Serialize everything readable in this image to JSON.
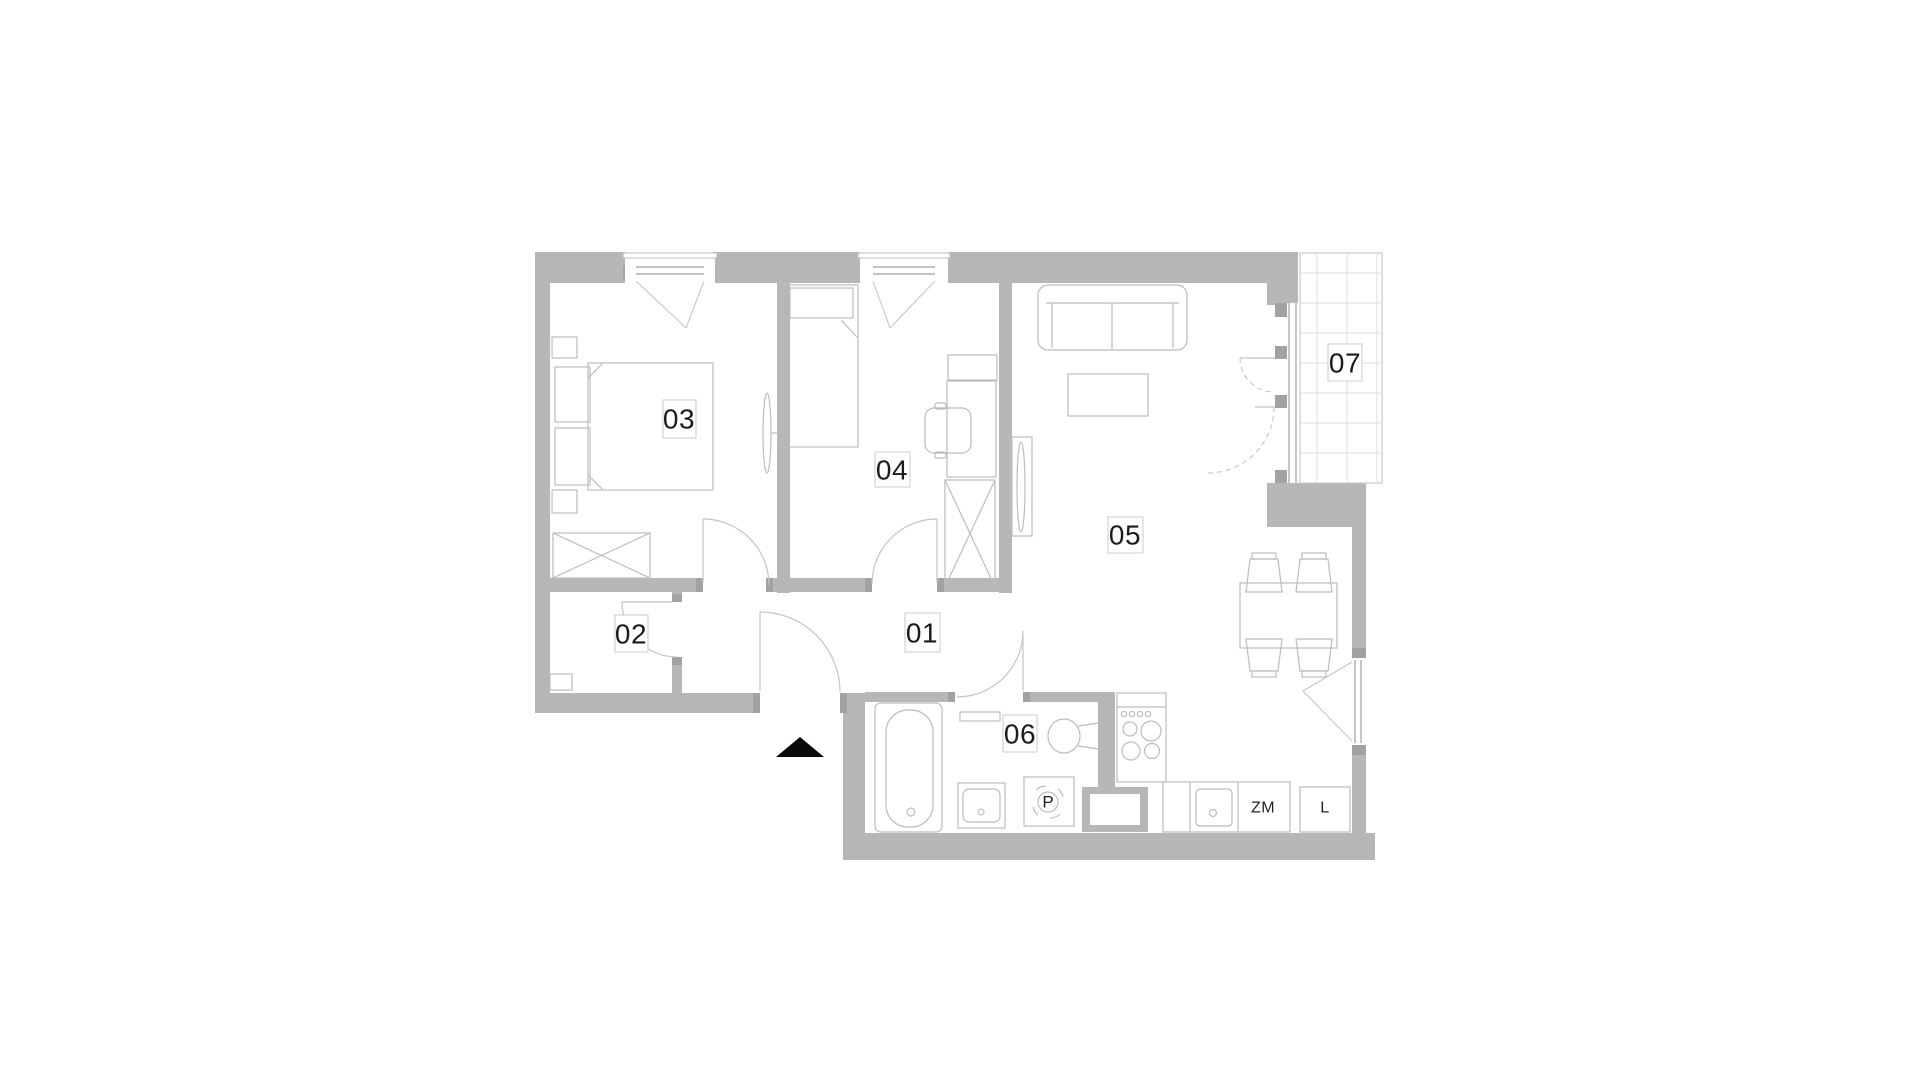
{
  "floor_plan": {
    "type": "apartment-floor-plan",
    "colors": {
      "background": "#ffffff",
      "wall": "#b7b7b7",
      "wall_cap": "#a2a2a2",
      "furniture_line": "#bcbcbc",
      "door_arc": "#c4c4c4",
      "tile_grid": "#dedede",
      "label_text": "#1b1b1b",
      "entrance_arrow": "#0a0a0a"
    },
    "rooms": [
      {
        "number": "01"
      },
      {
        "number": "02"
      },
      {
        "number": "03"
      },
      {
        "number": "04"
      },
      {
        "number": "05"
      },
      {
        "number": "06"
      },
      {
        "number": "07"
      }
    ],
    "appliances": {
      "washing_machine": "P",
      "dishwasher": "ZM",
      "fridge": "L"
    }
  }
}
